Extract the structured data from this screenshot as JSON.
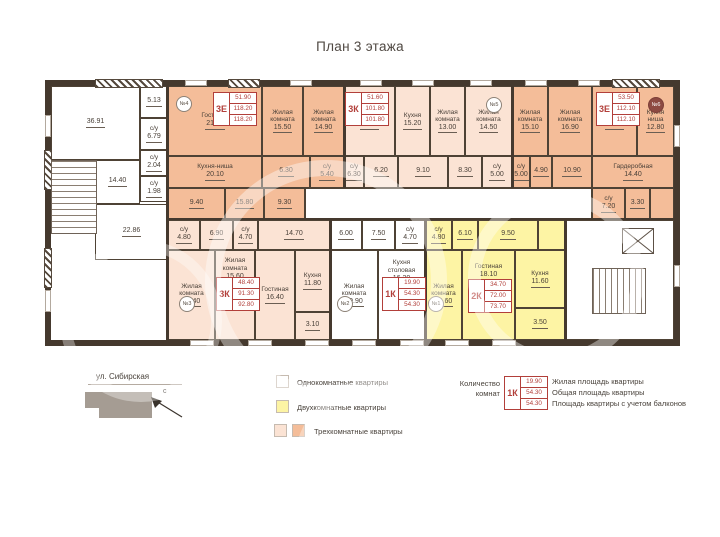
{
  "title": "План 3 этажа",
  "street_label": "ул. Сибирская",
  "north_label": "с",
  "colors": {
    "one_room": "#ffffff",
    "two_room": "#fdf4a4",
    "three_room_light": "#fbe3d4",
    "three_room_dark": "#f4bd99",
    "wall": "#45392e",
    "stamp_red": "#b23f3a"
  },
  "legend": {
    "one_room": "Однокомнатные квартиры",
    "two_room": "Двухкомнатные квартиры",
    "three_room": "Трехкомнатные квартиры",
    "rooms_count_line1": "Количество",
    "rooms_count_line2": "комнат",
    "sample": {
      "type": "1К",
      "living": "19.90",
      "total": "54.30",
      "total_balcony": "54.30"
    },
    "living_desc": "Жилая площадь квартиры",
    "total_desc": "Общая площадь квартиры",
    "balcony_desc": "Площадь квартиры с учетом балконов"
  },
  "apartments": {
    "apt4": {
      "badge": "№4",
      "type": "3Е",
      "living": "51.90",
      "total": "118.20",
      "total_balcony": "118.20"
    },
    "apt5": {
      "badge": "№5",
      "type": "3К",
      "living": "51.60",
      "total": "101.80",
      "total_balcony": "101.80"
    },
    "apt6": {
      "badge": "№6",
      "type": "3Е",
      "living": "53.50",
      "total": "112.10",
      "total_balcony": "112.10"
    },
    "apt3": {
      "badge": "№3",
      "type": "3К",
      "living": "48.40",
      "total": "91.30",
      "total_balcony": "92.80"
    },
    "apt2": {
      "badge": "№2",
      "type": "1К",
      "living": "19.90",
      "total": "54.30",
      "total_balcony": "54.30"
    },
    "apt1": {
      "badge": "№1",
      "type": "2К",
      "living": "34.70",
      "total": "72.00",
      "total_balcony": "73.70"
    }
  },
  "rooms": {
    "c1": {
      "name": "",
      "area": "36.91"
    },
    "c2": {
      "name": "",
      "area": "5.13"
    },
    "c3": {
      "name": "с/у",
      "area": "6.79"
    },
    "c4": {
      "name": "",
      "area": "14.40"
    },
    "c5": {
      "name": "с/у",
      "area": "2.04"
    },
    "c6": {
      "name": "с/у",
      "area": "1.98"
    },
    "c7": {
      "name": "",
      "area": "22.86"
    },
    "a4_1": {
      "name": "Гостиная",
      "area": "21.50"
    },
    "a4_2": {
      "name": "Жилая комната",
      "area": "15.50"
    },
    "a4_3": {
      "name": "Жилая комната",
      "area": "14.90"
    },
    "a4_4": {
      "name": "Кухня-ниша",
      "area": "20.10"
    },
    "a4_5": {
      "name": "",
      "area": "6.30"
    },
    "a4_6": {
      "name": "с/у",
      "area": "5.40"
    },
    "a4_7": {
      "name": "",
      "area": "9.40"
    },
    "a4_8": {
      "name": "",
      "area": "15.80"
    },
    "a4_9": {
      "name": "",
      "area": "9.30"
    },
    "a5_1": {
      "name": "Гостиная",
      "area": "24.10"
    },
    "a5_2": {
      "name": "Кухня",
      "area": "15.20"
    },
    "a5_3": {
      "name": "Жилая комната",
      "area": "13.00"
    },
    "a5_4": {
      "name": "Жилая комната",
      "area": "14.50"
    },
    "a5_5": {
      "name": "с/у",
      "area": "6.30"
    },
    "a5_6": {
      "name": "",
      "area": "6.20"
    },
    "a5_7": {
      "name": "",
      "area": "9.10"
    },
    "a5_8": {
      "name": "",
      "area": "8.30"
    },
    "a5_9": {
      "name": "с/у",
      "area": "5.00"
    },
    "a6_1": {
      "name": "Жилая комната",
      "area": "15.10"
    },
    "a6_2": {
      "name": "Жилая комната",
      "area": "16.90"
    },
    "a6_3": {
      "name": "Гостиная",
      "area": "21.50"
    },
    "a6_4": {
      "name": "Кухня ниша",
      "area": "12.80"
    },
    "a6_5": {
      "name": "с/у",
      "area": "5.00"
    },
    "a6_6": {
      "name": "",
      "area": "4.90"
    },
    "a6_7": {
      "name": "",
      "area": "10.90"
    },
    "a6_8": {
      "name": "Гардеробная",
      "area": "14.40"
    },
    "a6_9": {
      "name": "с/у",
      "area": "7.20"
    },
    "a6_10": {
      "name": "",
      "area": "3.30"
    },
    "a3_1": {
      "name": "с/у",
      "area": "4.80"
    },
    "a3_2": {
      "name": "",
      "area": "6.90"
    },
    "a3_3": {
      "name": "с/у",
      "area": "4.70"
    },
    "a3_4": {
      "name": "",
      "area": "14.70"
    },
    "a3_5": {
      "name": "Жилая комната",
      "area": "16.40"
    },
    "a3_6": {
      "name": "Жилая комната",
      "area": "15.60"
    },
    "a3_7": {
      "name": "Гостиная",
      "area": "16.40"
    },
    "a3_8": {
      "name": "Кухня",
      "area": "11.80"
    },
    "a3_9": {
      "name": "",
      "area": "3.10"
    },
    "a2_1": {
      "name": "",
      "area": "6.00"
    },
    "a2_2": {
      "name": "",
      "area": "7.50"
    },
    "a2_3": {
      "name": "с/у",
      "area": "4.70"
    },
    "a2_4": {
      "name": "Жилая комната",
      "area": "19.90"
    },
    "a2_5": {
      "name": "Кухня столовая",
      "area": "16.20"
    },
    "a1_1": {
      "name": "с/у",
      "area": "4.80"
    },
    "a1_2": {
      "name": "",
      "area": "6.10"
    },
    "a1_3": {
      "name": "",
      "area": "9.50"
    },
    "a1_4": {
      "name": "Жилая комната",
      "area": "16.60"
    },
    "a1_5": {
      "name": "Гостиная",
      "area": "18.10"
    },
    "a1_6": {
      "name": "Кухня",
      "area": "11.60"
    },
    "a1_7": {
      "name": "",
      "area": "3.50"
    }
  }
}
